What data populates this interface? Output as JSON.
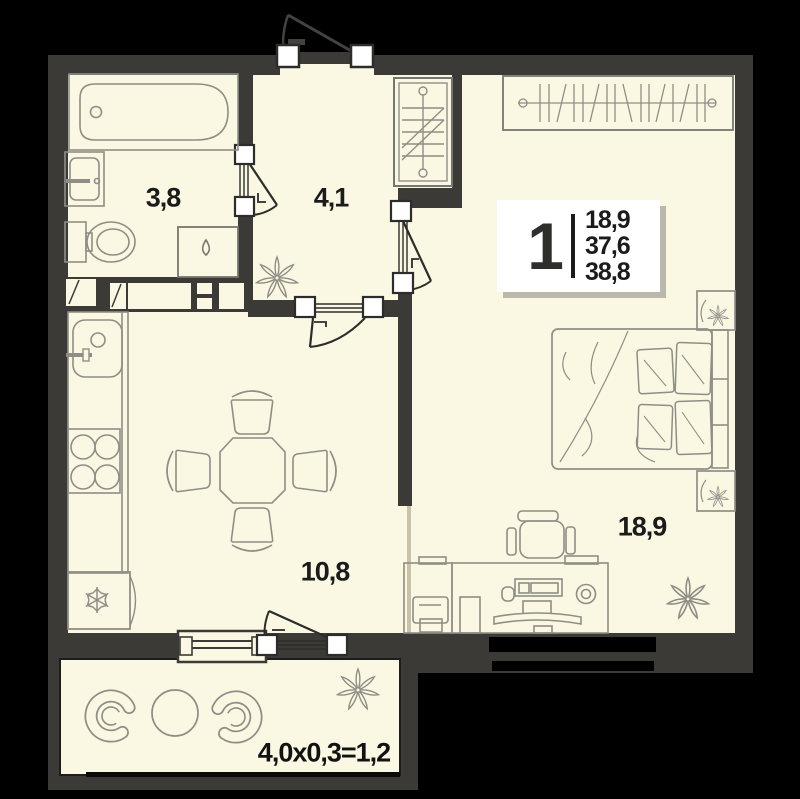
{
  "plan_title": "one-room apartment floor plan",
  "rooms": {
    "bathroom": {
      "label": "3,8"
    },
    "hallway": {
      "label": "4,1"
    },
    "kitchen_living": {
      "label": "10,8"
    },
    "bedroom": {
      "label": "18,9"
    }
  },
  "badge": {
    "room_count": "1",
    "area_1": "18,9",
    "area_2": "37,6",
    "area_3": "38,8"
  },
  "balcony": {
    "label": "4,0x0,3=1,2"
  },
  "colors": {
    "background": "#000000",
    "floor": "#FAF8E3",
    "wall": "#3B3A37",
    "furniture_outline": "#8F8E86",
    "furniture_outline_dark": "#77766E",
    "text": "#1B1B1B",
    "badge_bg": "#FFFFFF",
    "badge_shadow": "#BAB7AB"
  },
  "icons": {
    "fridge": "snowflake-icon",
    "washing_machine": "droplet-icon",
    "plants": "flower-icon",
    "wardrobes": "hanger-rail-icon"
  }
}
